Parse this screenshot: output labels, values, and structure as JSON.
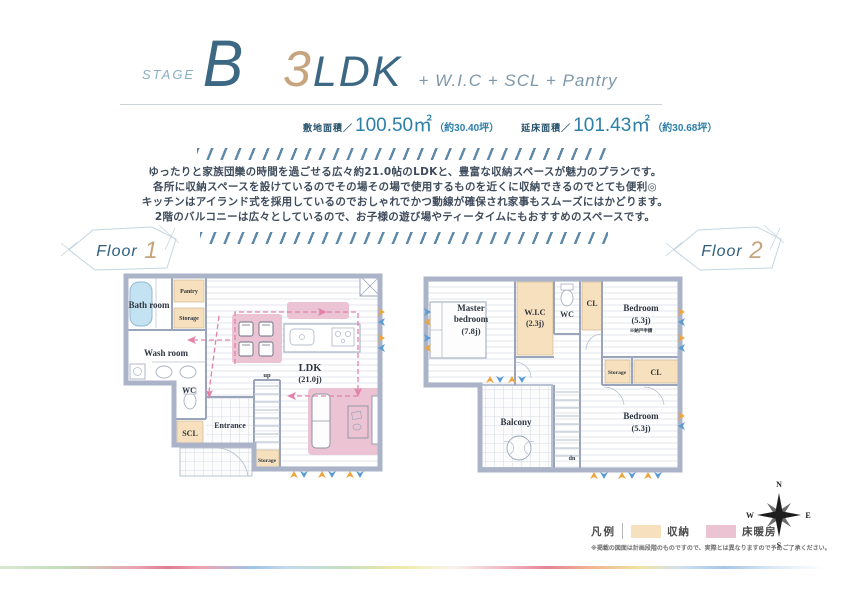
{
  "header": {
    "stage_label": "STAGE",
    "stage_letter": "B",
    "plan_number": "3",
    "plan_ldk": "LDK",
    "plan_extras": "+ W.I.C + SCL + Pantry"
  },
  "areas": {
    "site_label": "敷地面積／",
    "site_value": "100.50㎡",
    "site_tsubo": "（約30.40坪）",
    "floor_label": "延床面積／",
    "floor_value": "101.43㎡",
    "floor_tsubo": "（約30.68坪）"
  },
  "description": {
    "lines": [
      "ゆったりと家族団欒の時間を過ごせる広々約21.0帖のLDKと、豊富な収納スペースが魅力のプランです。",
      "各所に収納スペースを設けているのでその場その場で使用するものを近くに収納できるのでとても便利◎",
      "キッチンはアイランド式を採用しているのでおしゃれでかつ動線が確保され家事もスムーズにはかどります。",
      "2階のバルコニーは広々としているので、お子様の遊び場やティータイムにもおすすめのスペースです。"
    ]
  },
  "floor1": {
    "badge_label": "Floor",
    "badge_number": "1",
    "rooms": {
      "bath": "Bath room",
      "pantry": "Pantry",
      "storage_top": "Storage",
      "wash": "Wash room",
      "wc": "WC",
      "scl": "SCL",
      "entrance": "Entrance",
      "up": "up",
      "storage_bottom": "Storage",
      "ldk": "LDK",
      "ldk_size": "(21.0j)"
    }
  },
  "floor2": {
    "badge_label": "Floor",
    "badge_number": "2",
    "rooms": {
      "master_line1": "Master",
      "master_line2": "bedroom",
      "master_size": "(7.8j)",
      "wic": "W.I.C",
      "wic_size": "(2.3j)",
      "wc": "WC",
      "cl_top": "CL",
      "bedroom1": "Bedroom",
      "bedroom1_size": "(5.3j)",
      "bedroom1_note": "※納戸申請",
      "storage": "Storage",
      "cl_mid": "CL",
      "balcony": "Balcony",
      "dn": "dn",
      "bedroom2": "Bedroom",
      "bedroom2_size": "(5.3j)"
    }
  },
  "compass": {
    "n": "N",
    "e": "E",
    "s": "S",
    "w": "W"
  },
  "legend": {
    "title": "凡例",
    "storage_label": "収納",
    "heating_label": "床暖房",
    "disclaimer": "※掲載の図面は計画段階のものですので、実際とは異なりますので予めご了承ください。"
  },
  "colors": {
    "accent_blue": "#3d6883",
    "accent_tan": "#c6a47e",
    "value_blue": "#2b7fa8",
    "hatch_blue": "#5e89a8",
    "wall": "#aab3c7",
    "storage_fill": "#f6e0bd",
    "heating_fill": "#ecc3d3",
    "bathtub_fill": "#c3e2f2",
    "flow_pink": "#e282aa",
    "arrow_orange": "#eda53f",
    "arrow_blue": "#5b9bd5"
  }
}
